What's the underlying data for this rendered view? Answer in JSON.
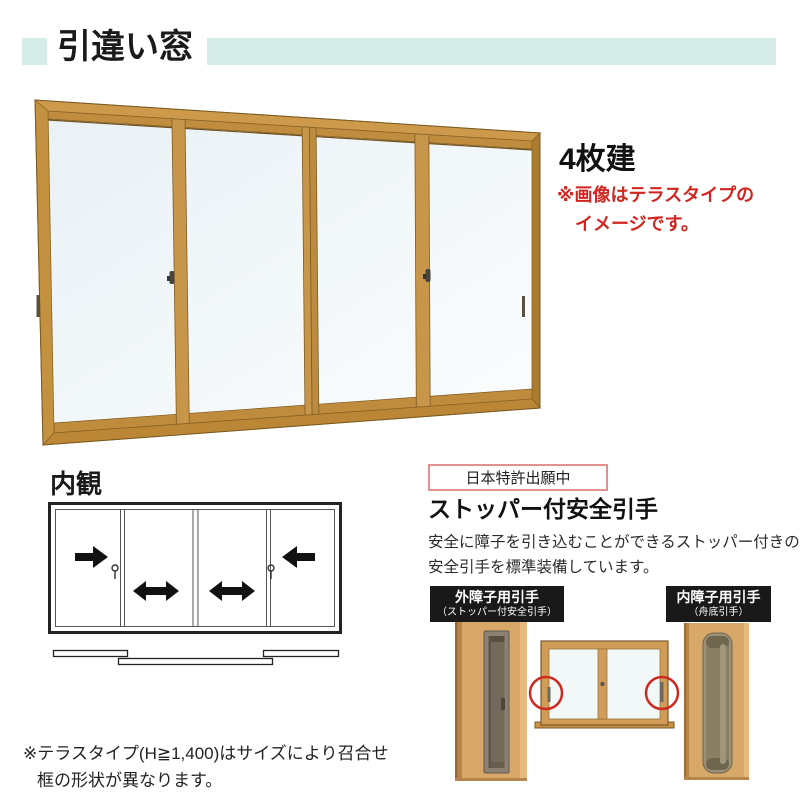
{
  "header": {
    "title": "引違い窓",
    "accent_color": "#d5ece7"
  },
  "hero": {
    "panel_count": "4枚建",
    "note_line1": "※画像はテラスタイプの",
    "note_line2": "イメージです。",
    "note_color": "#d2251f",
    "image_subject": "4-panel sliding window, gold/wood colored frame, perspective view"
  },
  "interior": {
    "title": "内観",
    "panel_arrows": [
      "slide-right",
      "slide-both-ways",
      "slide-both-ways",
      "slide-left"
    ],
    "icons": [
      "crescent-lock-icon",
      "crescent-lock-icon"
    ],
    "plan_view": "three offset track bars under frame"
  },
  "feature": {
    "patent": "日本特許出願中",
    "title": "ストッパー付安全引手",
    "desc_line1": "安全に障子を引き込むことができるストッパー付きの",
    "desc_line2": "安全引手を標準装備しています。",
    "outer_label_line1": "外障子用引手",
    "outer_label_line2": "（ストッパー付安全引手）",
    "inner_label_line1": "内障子用引手",
    "inner_label_line2": "（舟底引手）",
    "highlight_icon": "red-circle-highlight"
  },
  "footer": {
    "note_line1": "※テラスタイプ(H≧1,400)はサイズにより召合せ",
    "note_line2": "框の形状が異なります。"
  },
  "colors": {
    "accent_teal": "#d5ece7",
    "note_red": "#d2251f",
    "patent_border": "#e49090",
    "label_bg": "#191919",
    "frame_wood": "#c8964a",
    "glass": "#eef4f7",
    "highlight_red": "#cf2a22"
  }
}
